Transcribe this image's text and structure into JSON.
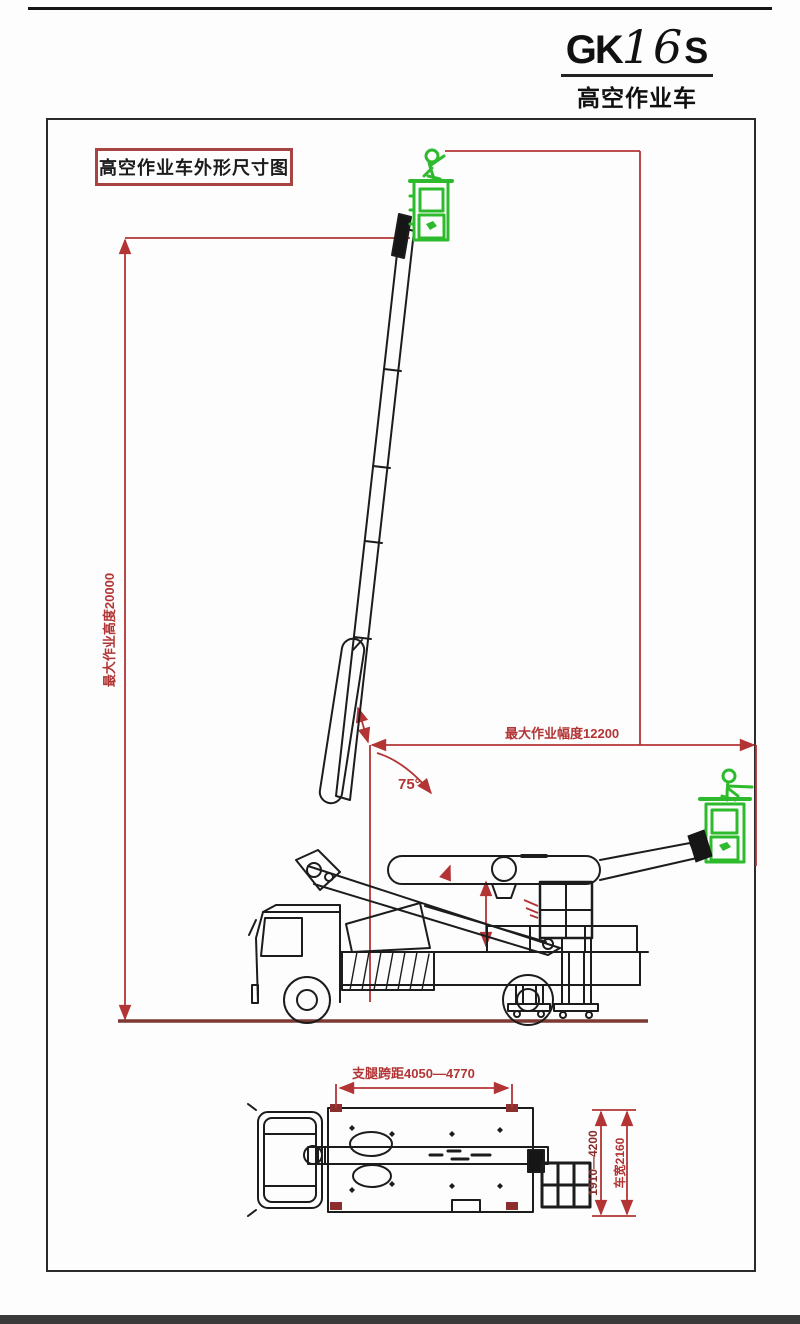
{
  "title": {
    "model_prefix": "GK",
    "model_number": "16",
    "model_suffix": "S",
    "subtitle": "高空作业车"
  },
  "drawing_labels": {
    "sheet_title": "高空作业车外形尺寸图",
    "max_height": "最大作业高度20000",
    "max_radius": "最大作业幅度12200",
    "boom_angle": "75°",
    "outrigger_span": "支腿跨距4050—4770",
    "slew_range": "1910—4200",
    "vehicle_width": "车宽2160"
  },
  "colors": {
    "dimension_red": "#b23434",
    "dark_red": "#8a2e2e",
    "basket_green": "#2dbb2d",
    "line_black": "#1c1c1c"
  }
}
